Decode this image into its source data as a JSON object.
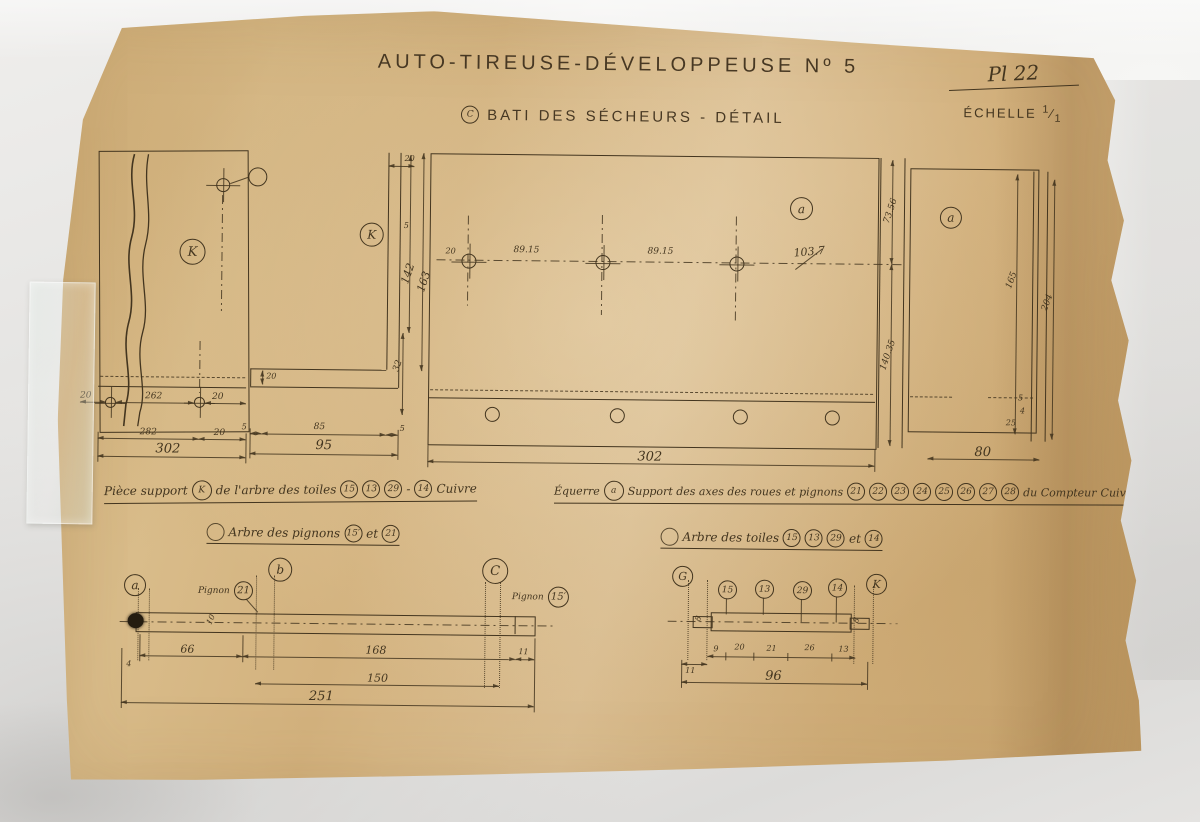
{
  "header": {
    "title": "AUTO-TIREUSE-DÉVELOPPEUSE  Nº 5",
    "subtitle_mark": "C",
    "subtitle": "BATI DES SÉCHEURS  -  DÉTAIL",
    "plate": "Pl 22",
    "scale_label": "ÉCHELLE",
    "scale_num": "1",
    "scale_den": "1"
  },
  "views": {
    "piece_k": {
      "ref": "K",
      "row1": [
        "20",
        "262",
        "20"
      ],
      "row2": [
        "282",
        "20"
      ],
      "total": "302"
    },
    "profile_k": {
      "ref": "K",
      "bottom": [
        "5",
        "85",
        "5"
      ],
      "total": "95",
      "vert": [
        "20",
        "5",
        "142",
        "163",
        "32"
      ],
      "foot": "20"
    },
    "panel_a": {
      "ref": "a",
      "axis": [
        "20",
        "89.15",
        "89.15",
        "103.7"
      ],
      "total": "302",
      "divider": [
        "73.56",
        "140.35"
      ]
    },
    "panel_a2": {
      "ref": "a",
      "total": "80",
      "vert": [
        "165",
        "204"
      ],
      "small": [
        "5",
        "4",
        "25"
      ]
    }
  },
  "captions": {
    "left": {
      "prefix": "Pièce support",
      "ref": "K",
      "mid": "de l'arbre des toiles",
      "n1": "15",
      "n2": "13",
      "n3": "29",
      "dash": "-",
      "n4": "14",
      "material": "Cuivre"
    },
    "right": {
      "prefix": "Équerre",
      "ref": "a",
      "mid": "Support des axes des roues et pignons",
      "n1": "21",
      "n2": "22",
      "n3": "23",
      "n4": "24",
      "n5": "25",
      "n6": "26",
      "n7": "27",
      "n8": "28",
      "suffix": "du Compteur",
      "material": "Cuivre"
    }
  },
  "subtitles": {
    "pignons": {
      "label": "Arbre des pignons",
      "n1": "15′",
      "joiner": "et",
      "n2": "21"
    },
    "toiles": {
      "label": "Arbre des toiles",
      "n1": "15",
      "n2": "13",
      "n3": "29",
      "joiner": "et",
      "n4": "14"
    }
  },
  "shaft1": {
    "ref_a": "a",
    "ref_b": "b",
    "ref_c": "C",
    "pignon_label": "Pignon",
    "pl_num": "21",
    "pr_num": "15′",
    "dia": "10",
    "d1": "66",
    "d2": "168",
    "d3": "11",
    "d4": "4",
    "mid": "150",
    "total": "251"
  },
  "shaft2": {
    "ref_left": "G",
    "ref_right": "K",
    "p1": "15",
    "p2": "13",
    "p3": "29",
    "p4": "14",
    "dia": "8",
    "d1": "11",
    "d2": "9",
    "d3": "20",
    "d4": "21",
    "d5": "26",
    "d6": "13",
    "total": "96"
  }
}
